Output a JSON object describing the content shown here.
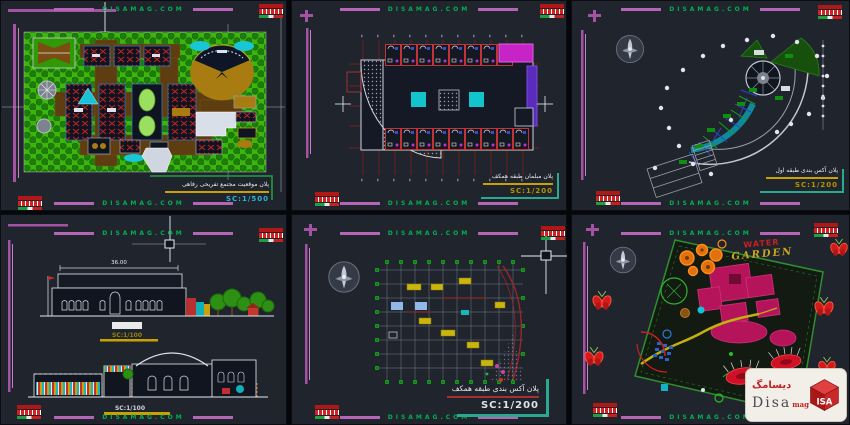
{
  "watermark": {
    "text": "DISAMAG.COM"
  },
  "brand": {
    "fa_name": "دیسامگ",
    "latin_main": "Disa",
    "latin_suffix": "mag",
    "cube_letters": "ISA"
  },
  "colors": {
    "watermark_green": "#00b050",
    "border_magenta": "#a452a4",
    "scale_yellow": "#b29600",
    "scale_cyan": "#2fb4d8",
    "logo_red": "#c41e1e",
    "teal_bracket": "#2aa890"
  },
  "panels": {
    "site_plan": {
      "title_fa": "پلان موقعیت مجتمع تفریحی رفاهی",
      "scale": "SC:1/500"
    },
    "furniture_plan": {
      "title_fa": "پلان مبلمان طبقه همکف",
      "scale": "SC:1/200"
    },
    "first_floor_plan": {
      "title_fa": "پلان آکس بندی طبقه اول",
      "scale": "SC:1/200"
    },
    "elevations": {
      "top_width_dim": "36.00",
      "scale_top": "SC:1/100",
      "scale_bottom": "SC:1/100"
    },
    "axes_plan": {
      "title_fa": "پلان آکس بندی طبقه همکف",
      "scale": "SC:1/200"
    },
    "garden_plan": {
      "label_word1": "WATER",
      "label_word2": "GARDEN"
    }
  }
}
